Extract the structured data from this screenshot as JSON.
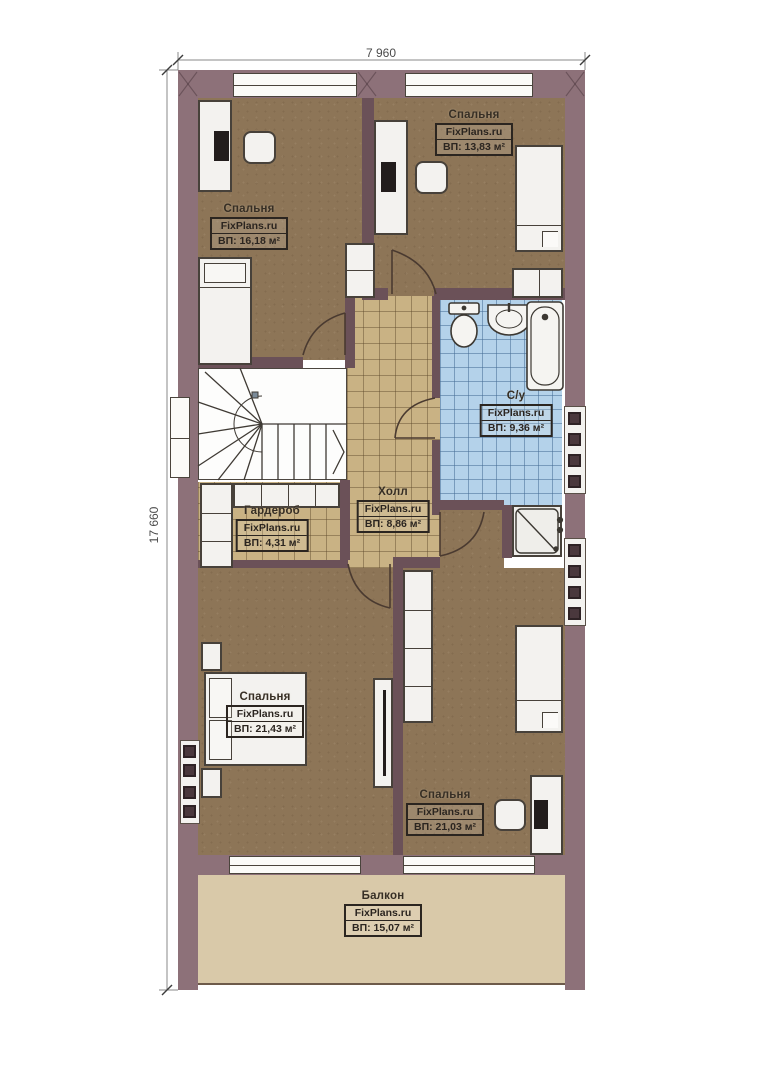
{
  "plan": {
    "type": "floor-plan",
    "dimensions": {
      "top": "7 960",
      "left": "17 660"
    },
    "rooms": [
      {
        "id": "bedroom-top-left",
        "name": "Спальня",
        "brand": "FixPlans.ru",
        "area": "ВП: 16,18 м²"
      },
      {
        "id": "bedroom-top-right",
        "name": "Спальня",
        "brand": "FixPlans.ru",
        "area": "ВП: 13,83 м²"
      },
      {
        "id": "bathroom",
        "name": "С/у",
        "brand": "FixPlans.ru",
        "area": "ВП: 9,36 м²"
      },
      {
        "id": "hall",
        "name": "Холл",
        "brand": "FixPlans.ru",
        "area": "ВП: 8,86 м²"
      },
      {
        "id": "wardrobe",
        "name": "Гардероб",
        "brand": "FixPlans.ru",
        "area": "ВП: 4,31 м²"
      },
      {
        "id": "bedroom-bottom-left",
        "name": "Спальня",
        "brand": "FixPlans.ru",
        "area": "ВП: 21,43 м²"
      },
      {
        "id": "bedroom-bottom-right",
        "name": "Спальня",
        "brand": "FixPlans.ru",
        "area": "ВП: 21,03 м²"
      },
      {
        "id": "balcony",
        "name": "Балкон",
        "brand": "FixPlans.ru",
        "area": "ВП: 15,07 м²"
      }
    ],
    "colors": {
      "exterior_wall": "#8d7179",
      "interior_wall": "#6b5158",
      "wood_floor": "#8d7557",
      "tan_tile": "#c9b284",
      "blue_tile": "#b4d2ea",
      "balcony_floor": "#d9c9a9"
    }
  }
}
